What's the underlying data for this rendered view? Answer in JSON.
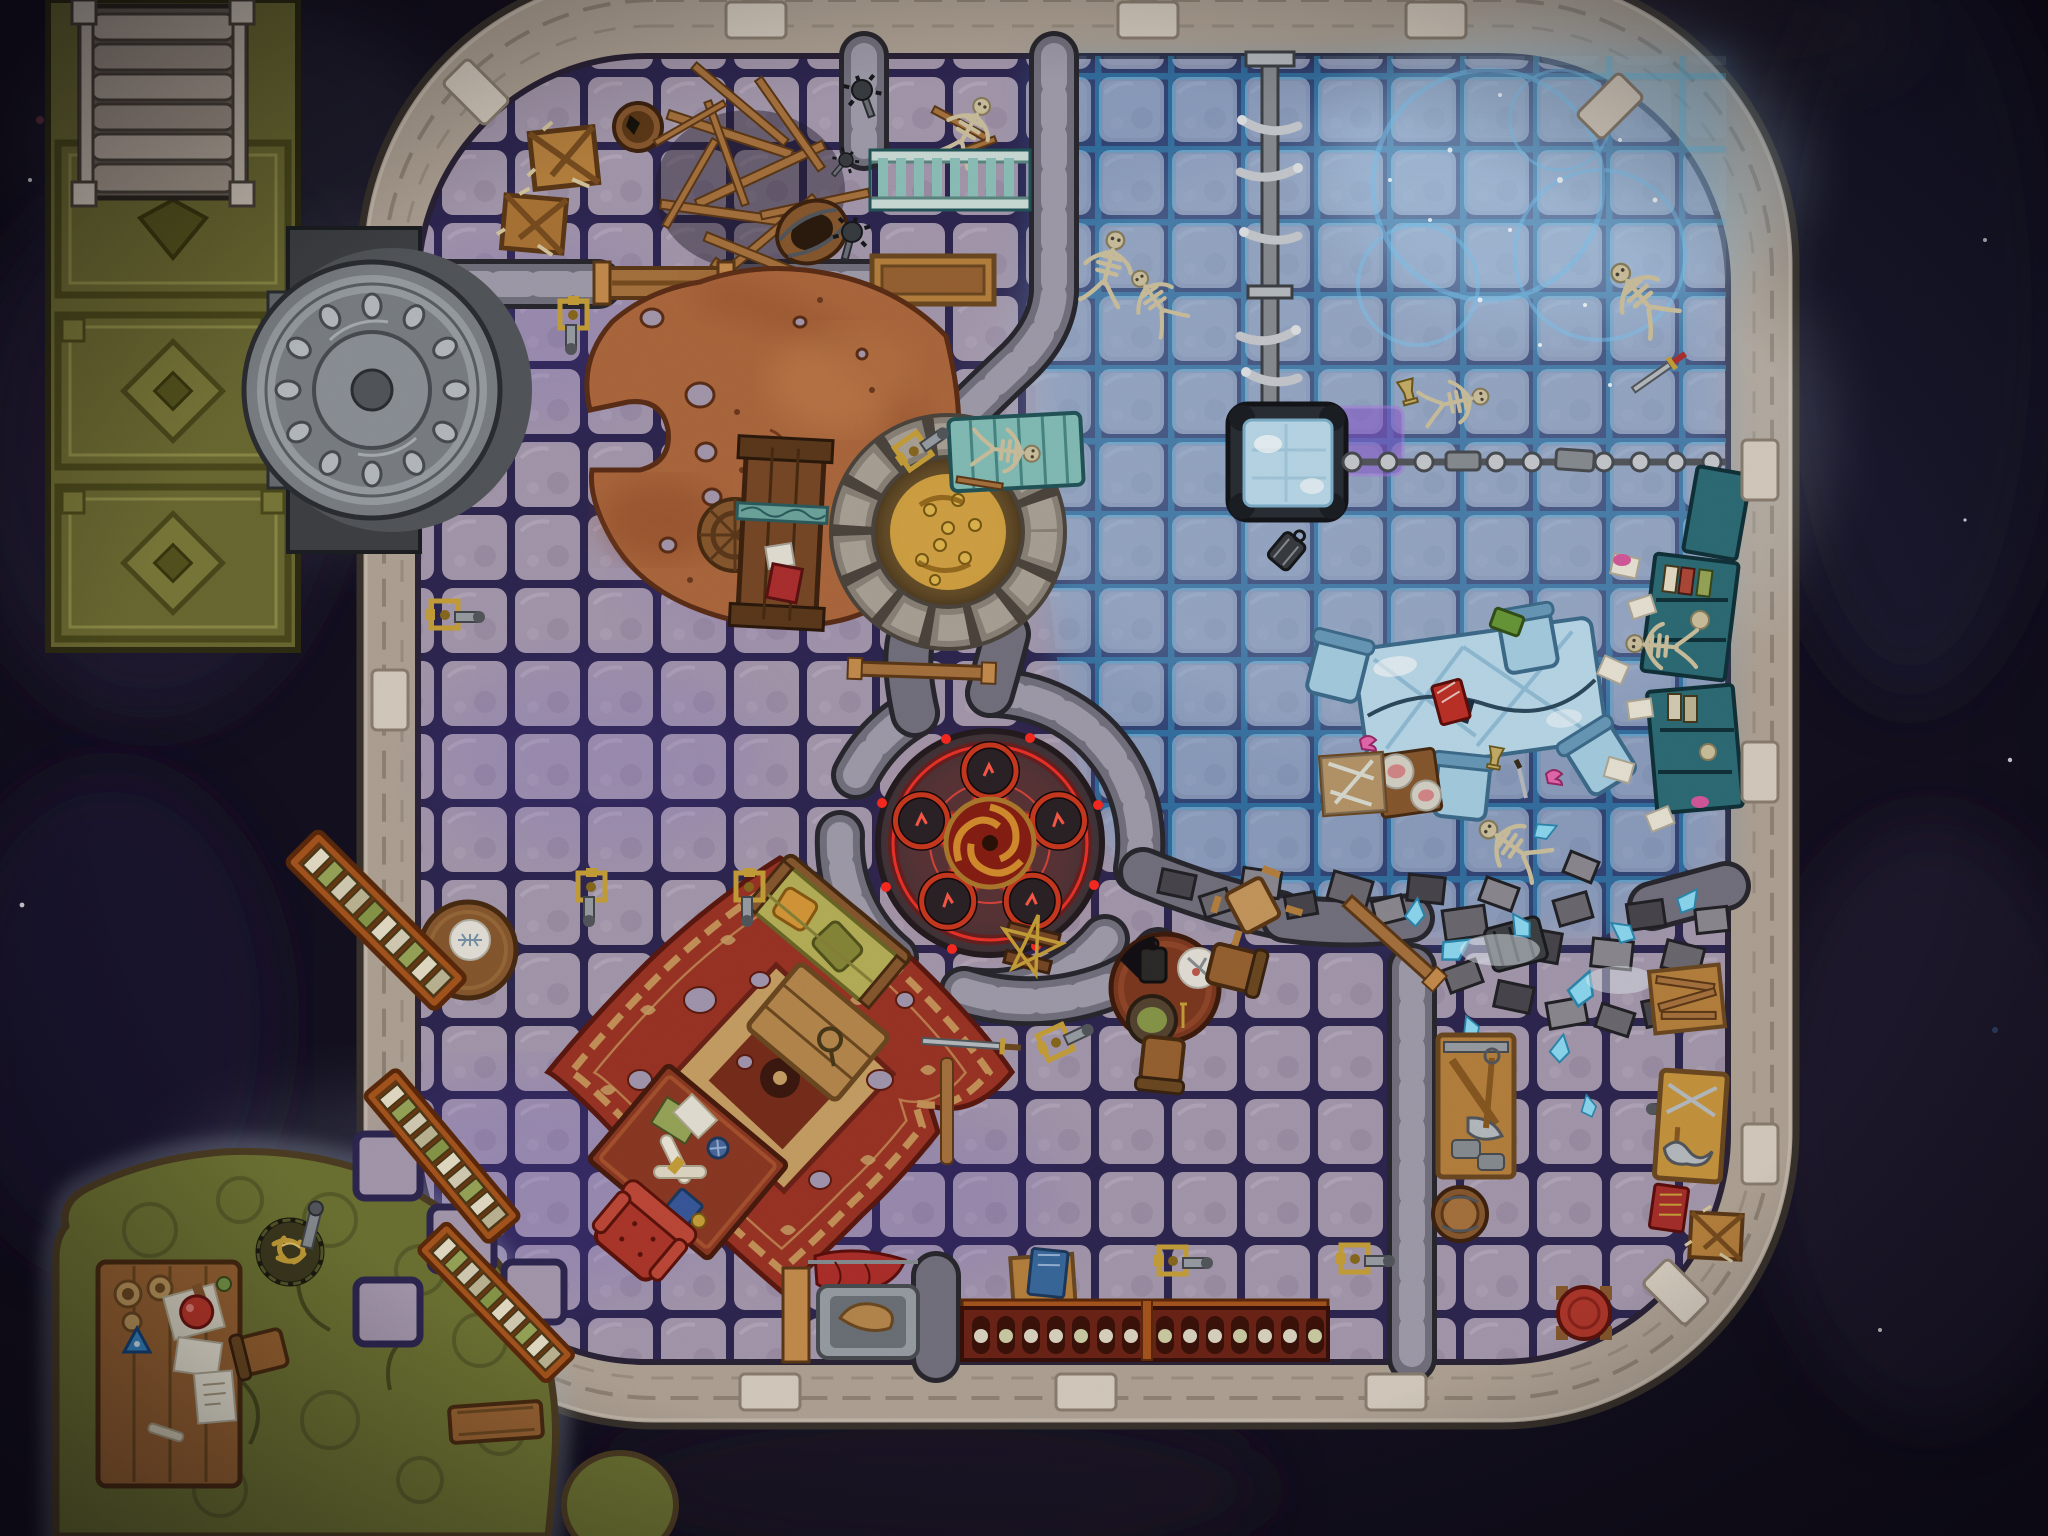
{
  "map": {
    "kind": "fantasy-dungeon-battle-map",
    "theme": "arcane prison ritual chamber, half frozen, viewed top-down",
    "grid": {
      "cell_px": 73,
      "cols": 28,
      "rows": 21
    },
    "regions": [
      {
        "id": "entry-staircase",
        "label": "stone staircase"
      },
      {
        "id": "armored-corridor",
        "label": "olive armored corridor with diamond plates"
      },
      {
        "id": "vault-door",
        "label": "round riveted steel vault door"
      },
      {
        "id": "storage-nook",
        "label": "broken crates, barrels and timber pile"
      },
      {
        "id": "prison-cell",
        "label": "cell with teal bars and skeleton"
      },
      {
        "id": "rusted-plate",
        "label": "huge rusted iron floor plate with sled"
      },
      {
        "id": "treasure-well",
        "label": "stone well filled with gold"
      },
      {
        "id": "frost-quadrant",
        "label": "frozen haunted quarter with ghost-light rings"
      },
      {
        "id": "hanging-platform",
        "label": "frosted platform with bone chain and wall chain"
      },
      {
        "id": "ice-banquet",
        "label": "frozen banquet table with icy chairs"
      },
      {
        "id": "wall-shelves",
        "label": "teal shelves with books, papers and bones"
      },
      {
        "id": "summoning-circle",
        "label": "glowing red pentagram summoning circle"
      },
      {
        "id": "dining-set",
        "label": "round table with lantern, plate, stew and chairs"
      },
      {
        "id": "study",
        "label": "red carpet study with couch, chest, desk, armchair"
      },
      {
        "id": "library-ladders",
        "label": "three leaning book ladders"
      },
      {
        "id": "collapsed-wall",
        "label": "rubble breach with ice shards"
      },
      {
        "id": "armory",
        "label": "tool board and weapon board room"
      },
      {
        "id": "scroll-cellar",
        "label": "scroll rack, stretcher, red cape"
      },
      {
        "id": "alchemist-cave",
        "label": "mossy grotto with potion table and gold basket"
      }
    ],
    "tokens": [
      "skeleton",
      "bone-chain",
      "sled",
      "gold-hoard",
      "gold-spill",
      "sickle",
      "ice-table",
      "ice-chair",
      "red-book",
      "green-book",
      "blue-tome",
      "plate-of-food",
      "pink-fish",
      "lantern",
      "goblet",
      "sword",
      "mace",
      "crate",
      "barrel",
      "stool",
      "stretcher",
      "red-cape",
      "torch-sconce",
      "scroll-rack",
      "potion-flask",
      "mortar",
      "triangle-amulet",
      "gold-basket",
      "star-graffiti",
      "magenta-glow-tile",
      "wooden-beam",
      "cell-bars"
    ]
  },
  "palette": {
    "void_bg": "#141020",
    "wall_stone": "#b3a698",
    "wall_edge": "#3a332e",
    "floor_tile": "#a89bb0",
    "floor_grout": "#2f2752",
    "frost_tint": "#3f93d2",
    "frost_grid": "#35b4e8",
    "olive_hall": "#6e6c33",
    "steel_door": "#7d8287",
    "rust_plate": "#b06a3f",
    "gold_treasure": "#c08f2e",
    "summon_red": "#ff352a",
    "circle_stone": "#38363c",
    "carpet_red": "#9e3526",
    "carpet_gold": "#c9955a",
    "couch_olive": "#b9b35a",
    "teal_bars": "#8fc4bc",
    "ice_blue": "#bcdcec",
    "shelf_teal": "#2e6e78",
    "cave_green": "#6f7434",
    "wood": "#a9743f",
    "wood_dark": "#8a5a30",
    "bone": "#cfc3a0",
    "accent_magenta": "#8a4fd0"
  }
}
